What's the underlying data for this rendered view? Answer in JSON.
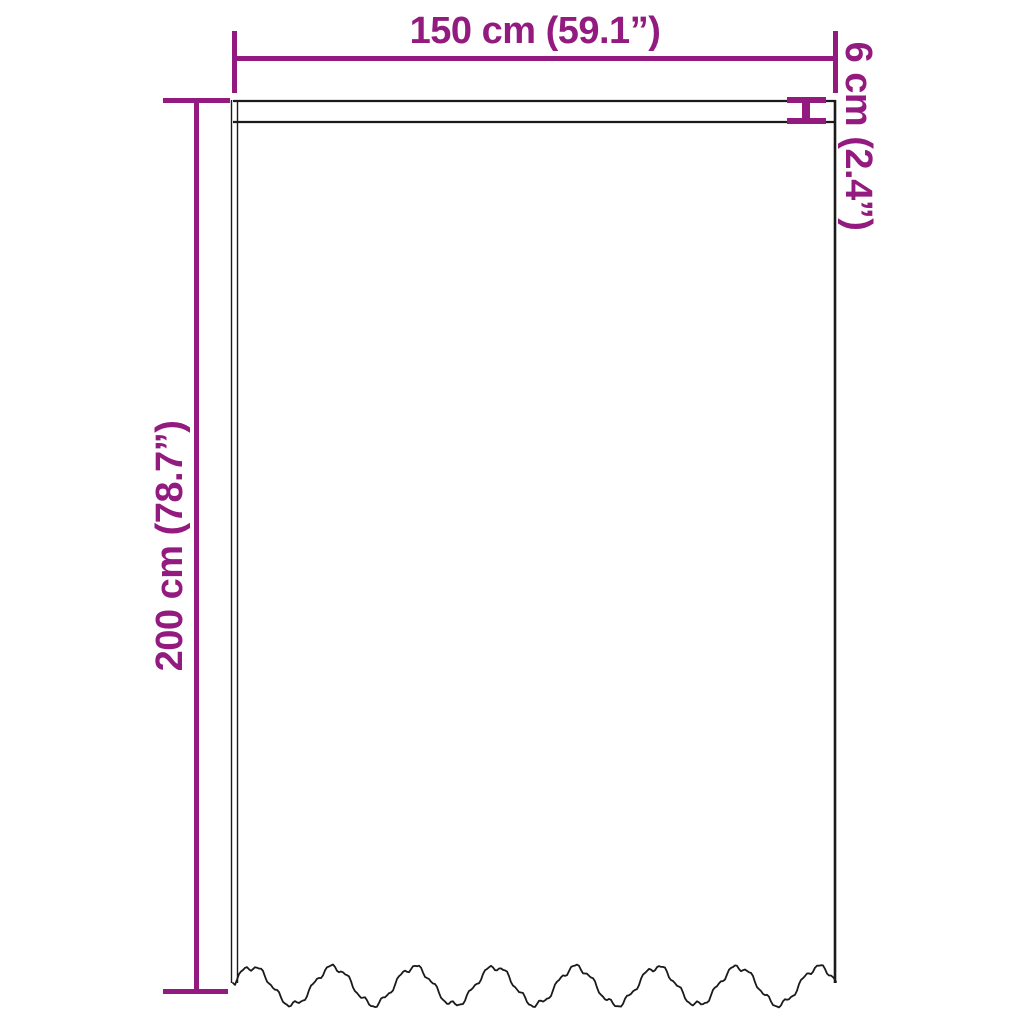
{
  "page": {
    "type": "product-dimension-diagram",
    "subject": "curtain",
    "background": "#ffffff"
  },
  "colors": {
    "accent": "#931b80",
    "outline": "#1a1a1a"
  },
  "dimensions": {
    "width": {
      "label": "150 cm (59.1”)",
      "cm": 150,
      "inches": 59.1
    },
    "height": {
      "label": "200 cm (78.7”)",
      "cm": 200,
      "inches": 78.7
    },
    "header": {
      "label": "6 cm (2.4”)",
      "cm": 6,
      "inches": 2.4
    }
  }
}
